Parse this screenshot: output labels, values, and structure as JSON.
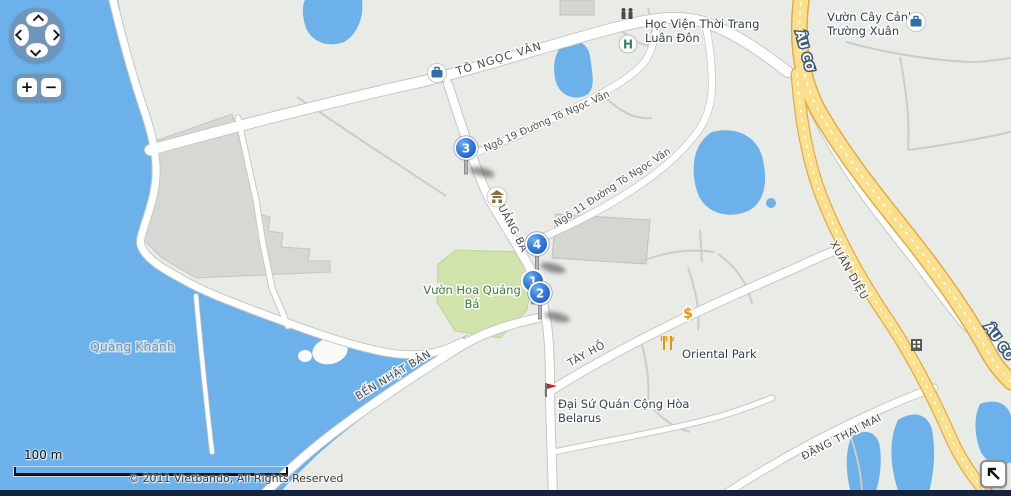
{
  "map": {
    "road_labels": {
      "to_ngoc_van": "TÔ NGỌC VÂN",
      "ngo_19": "Ngõ 19 Đường Tô Ngọc Vân",
      "ngo_11": "Ngõ 11 Đường Tô Ngọc Vân",
      "quang_ba": "QUẢNG BÁ",
      "ben_nhat_ban": "BẾN NHẬT BẢN",
      "tay_ho": "TÂY HỒ",
      "xuan_dieu": "XUÂN DIỆU",
      "au_co_north": "ÂU CƠ",
      "au_co_south": "ÂU CƠ",
      "dang_thai_mai": "ĐẶNG THAI MAI"
    },
    "poi_labels": {
      "hoc_vien_line1": "Học Viện Thời Trang",
      "hoc_vien_line2": "Luân Đôn",
      "vuon_cay_line1": "Vườn Cây Cảnh",
      "vuon_cay_line2": "Trường Xuân",
      "vuon_hoa_line1": "Vườn Hoa Quảng",
      "vuon_hoa_line2": "Bá",
      "quang_khanh": "Quảng Khánh",
      "oriental_park": "Oriental Park",
      "embassy_line1": "Đại Sứ Quán Cộng Hòa",
      "embassy_line2": "Belarus"
    },
    "icons": {
      "hospital": "H",
      "money": "$"
    },
    "markers": [
      {
        "label": "3"
      },
      {
        "label": "4"
      },
      {
        "label": "1"
      },
      {
        "label": "2"
      }
    ],
    "scale_label": "100 m",
    "copyright": "© 2011 Vietbando, All Rights Reserved",
    "colors": {
      "water": "#6cb1e9",
      "land": "#e9ebe7",
      "park": "#cfe3ab",
      "road_yellow": "#fadf8d",
      "marker_blue": "#2268d4"
    }
  },
  "controls": {
    "zoom_in_label": "+",
    "zoom_out_label": "−"
  }
}
